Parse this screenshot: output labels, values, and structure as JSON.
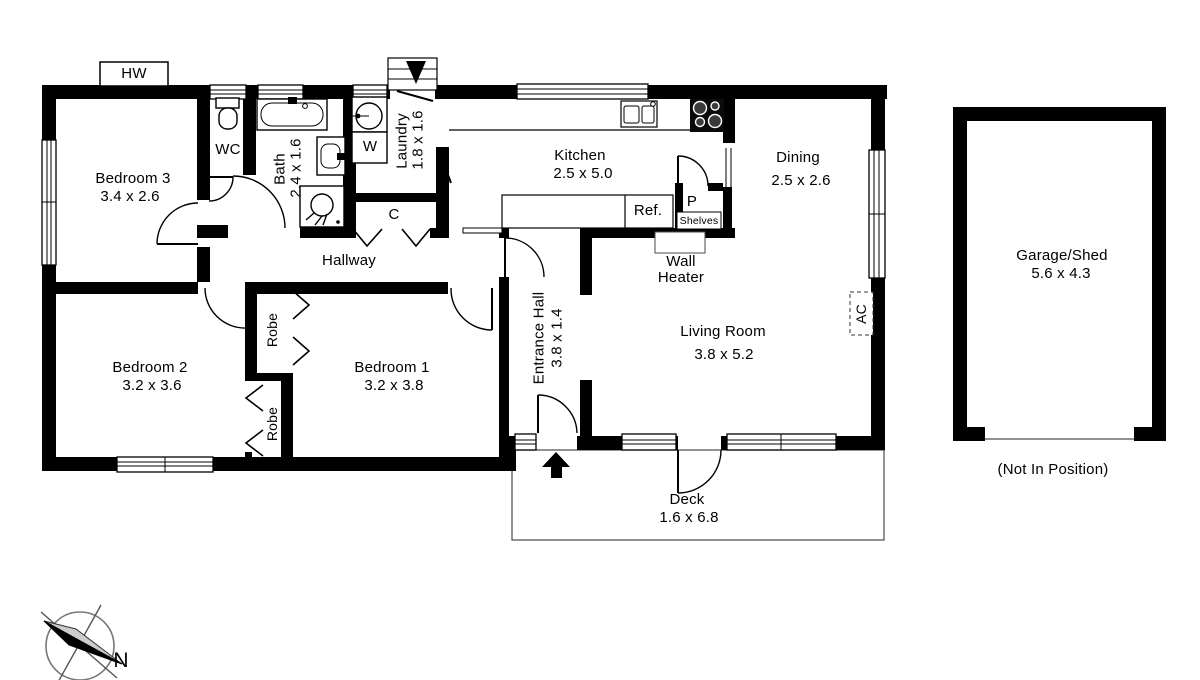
{
  "rooms": {
    "bedroom1": {
      "name": "Bedroom 1",
      "dims": "3.2 x 3.8"
    },
    "bedroom2": {
      "name": "Bedroom 2",
      "dims": "3.2 x 3.6"
    },
    "bedroom3": {
      "name": "Bedroom 3",
      "dims": "3.4 x 2.6"
    },
    "wc": {
      "name": "WC"
    },
    "bath": {
      "name": "Bath",
      "dims": "2.4 x 1.6"
    },
    "laundry": {
      "name": "Laundry",
      "dims": "1.8 x 1.6"
    },
    "kitchen": {
      "name": "Kitchen",
      "dims": "2.5 x 5.0"
    },
    "dining": {
      "name": "Dining",
      "dims": "2.5 x 2.6"
    },
    "living_room": {
      "name": "Living Room",
      "dims": "3.8 x 5.2"
    },
    "entrance_hall": {
      "name": "Entrance Hall",
      "dims": "3.8 x 1.4"
    },
    "hallway": {
      "name": "Hallway"
    },
    "deck": {
      "name": "Deck",
      "dims": "1.6 x 6.8"
    },
    "garage": {
      "name": "Garage/Shed",
      "dims": "5.6 x 4.3",
      "note": "(Not In Position)"
    }
  },
  "fixtures": {
    "hot_water": "HW",
    "washer": "W",
    "cupboard": "C",
    "pantry": "P",
    "shelves": "Shelves",
    "refrigerator": "Ref.",
    "wall_heater": "Wall Heater",
    "air_conditioner": "AC",
    "robe": "Robe"
  },
  "compass": {
    "north": "N"
  },
  "colors": {
    "wall": "#000000",
    "thin_line": "#4a4a4a"
  }
}
